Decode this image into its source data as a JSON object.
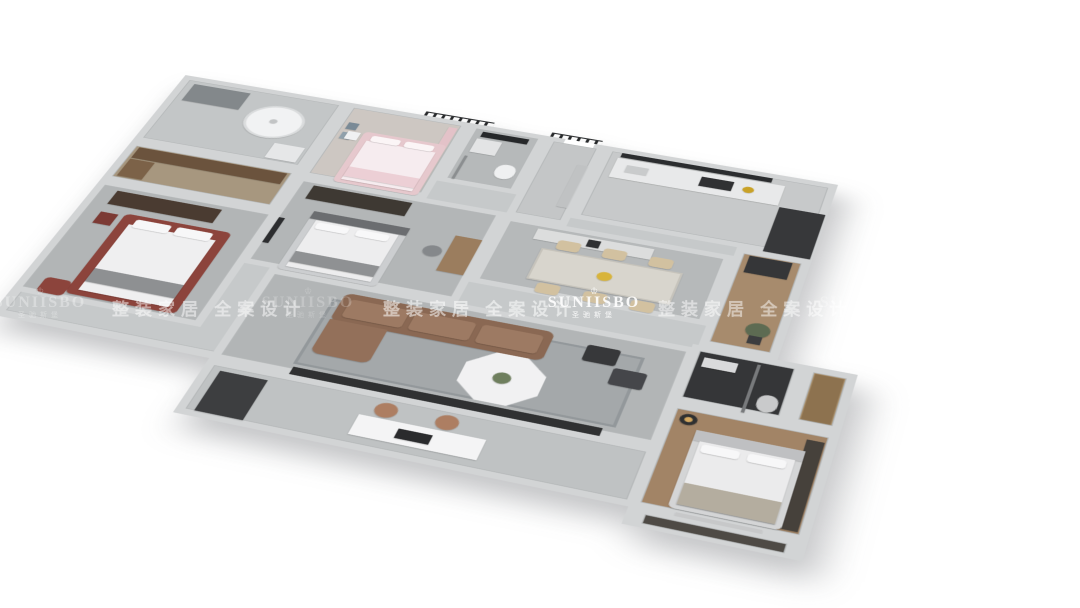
{
  "brand": {
    "logo_text": "SUNIISBO",
    "logo_subtext": "圣驰斯堡",
    "crown_icon": "♔"
  },
  "watermark": {
    "band_text": "整装家居 全案设计"
  },
  "palette": {
    "background": "#ffffff",
    "wall": "#d2d4d5",
    "floor_gray": "#b3b6b7",
    "floor_marble": "#bfc2c3",
    "floor_wood": "#a28466",
    "furniture_dark": "#37383a",
    "sofa_brown": "#8a6853",
    "dining_chair_beige": "#d2c1a0",
    "bed_pink": "#e6c8cd",
    "bed_red_frame": "#8c443c",
    "copper_chair": "#ad7e62",
    "watermark_white": "#ffffff"
  },
  "rooms": [
    "master-bathroom",
    "walk-in-closet",
    "elder-bedroom",
    "kids-bedroom",
    "guest-bathroom",
    "entry-hall",
    "kitchen",
    "dining-room",
    "second-bedroom",
    "corridor",
    "living-room",
    "laundry-balcony",
    "leisure-balcony",
    "ensuite-bathroom",
    "master-closet",
    "master-bedroom",
    "master-balcony"
  ]
}
